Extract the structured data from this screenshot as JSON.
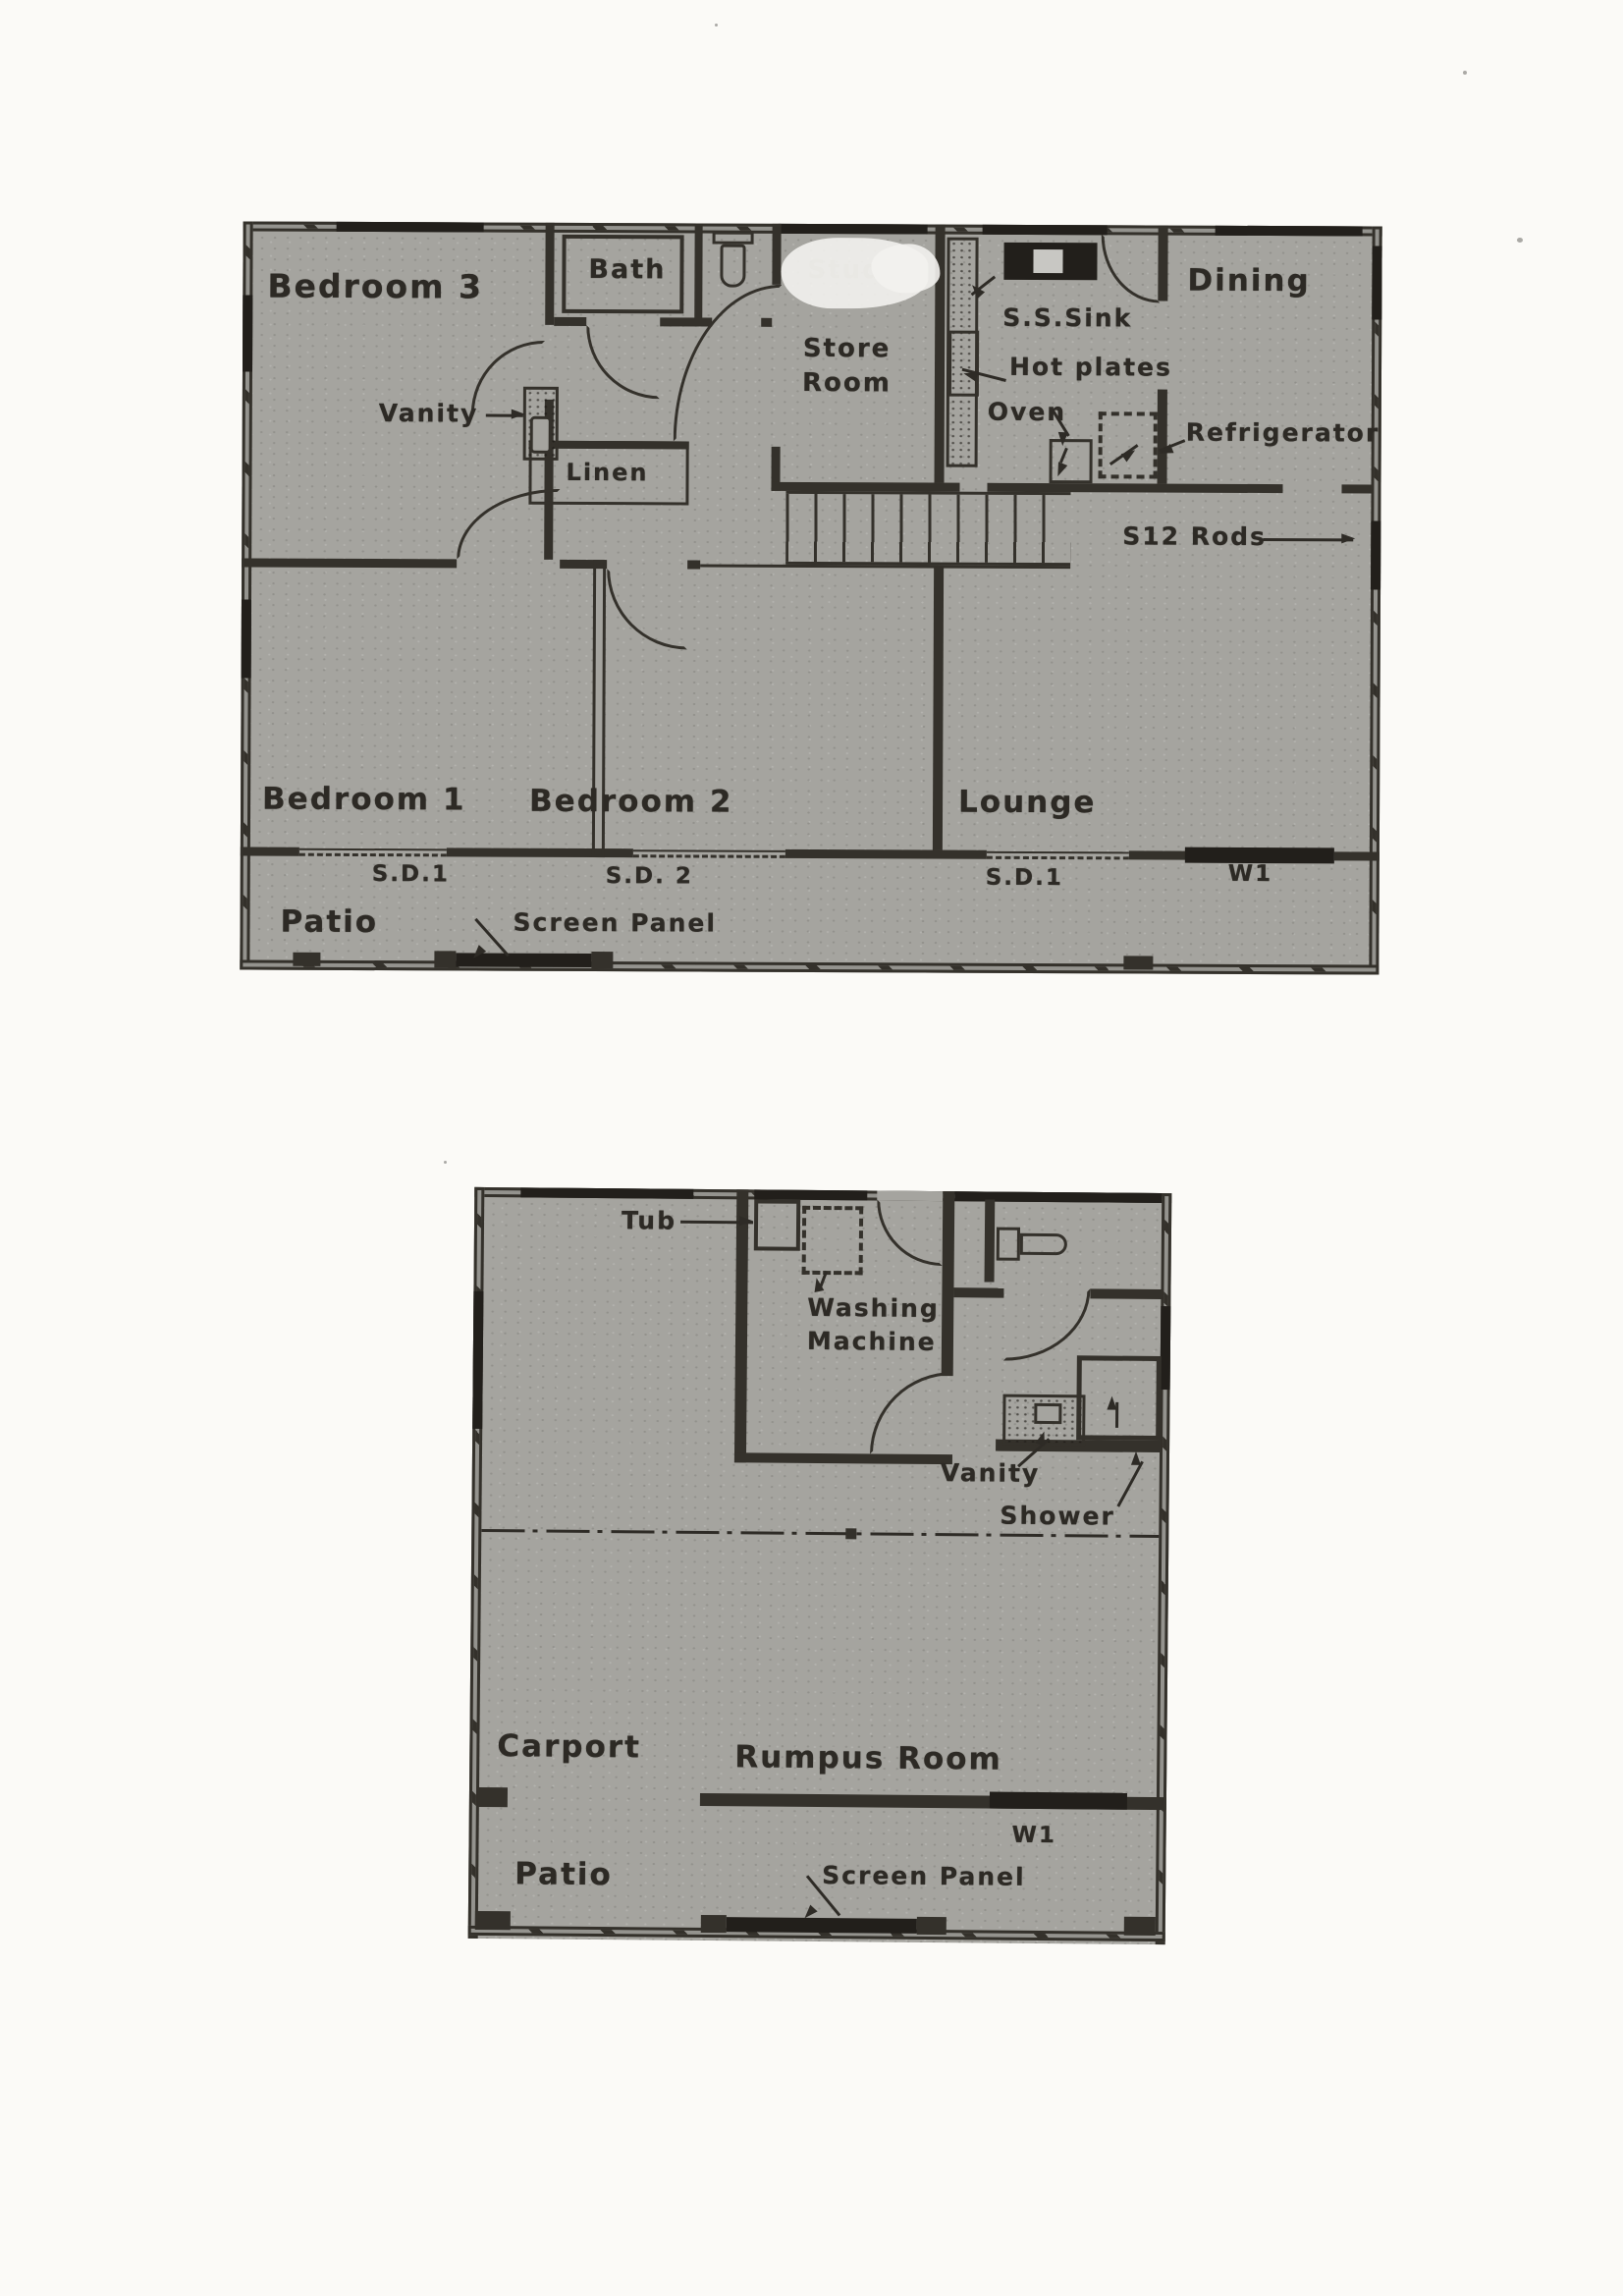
{
  "colors": {
    "paper": "#fbfaf7",
    "plan_fill": "#a5a49f",
    "wall": "#34312b",
    "ink": "#2d2a25",
    "whiteout": "#f3f2ee"
  },
  "upper_plan": {
    "rooms": {
      "bedroom3": "Bedroom 3",
      "bath": "Bath",
      "store_room": "Store Room",
      "dining": "Dining",
      "bedroom1": "Bedroom 1",
      "bedroom2": "Bedroom 2",
      "lounge": "Lounge",
      "patio": "Patio"
    },
    "obscured_label": "Study",
    "fixtures": {
      "vanity": "Vanity",
      "linen": "Linen",
      "sink": "S.S.Sink",
      "hot_plates": "Hot plates",
      "oven": "Oven",
      "refrigerator": "Refrigerator",
      "rods": "S12 Rods"
    },
    "openings": {
      "sd1_bed1": "S.D.1",
      "sd2_bed2": "S.D. 2",
      "sd1_lounge": "S.D.1",
      "w1": "W1"
    },
    "screen_panel": "Screen Panel"
  },
  "lower_plan": {
    "rooms": {
      "carport": "Carport",
      "rumpus": "Rumpus Room",
      "patio": "Patio"
    },
    "fixtures": {
      "tub": "Tub",
      "washing_machine": "Washing Machine",
      "vanity": "Vanity",
      "shower": "Shower"
    },
    "openings": {
      "w1": "W1"
    },
    "screen_panel": "Screen Panel"
  }
}
